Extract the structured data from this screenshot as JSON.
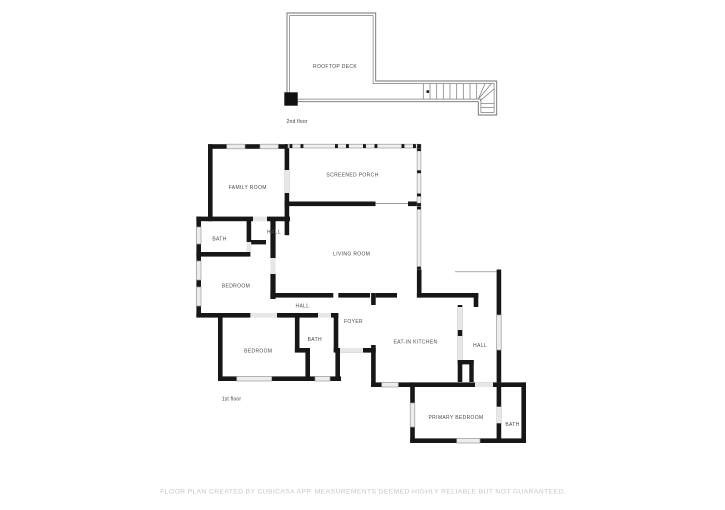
{
  "floors": [
    {
      "id": "second-floor",
      "label": "2nd floor",
      "rooms": [
        {
          "id": "rooftop-deck",
          "label": "ROOFTOP DECK"
        }
      ]
    },
    {
      "id": "first-floor",
      "label": "1st floor",
      "rooms": [
        {
          "id": "family-room",
          "label": "FAMILY ROOM"
        },
        {
          "id": "screened-porch",
          "label": "SCREENED PORCH"
        },
        {
          "id": "bath-upper",
          "label": "BATH"
        },
        {
          "id": "hall-upper",
          "label": "HALL"
        },
        {
          "id": "living-room",
          "label": "LIVING ROOM"
        },
        {
          "id": "bedroom-upper",
          "label": "BEDROOM"
        },
        {
          "id": "hall-center",
          "label": "HALL"
        },
        {
          "id": "foyer",
          "label": "FOYER"
        },
        {
          "id": "bath-center",
          "label": "BATH"
        },
        {
          "id": "bedroom-lower",
          "label": "BEDROOM"
        },
        {
          "id": "eat-in-kitchen",
          "label": "EAT-IN KITCHEN"
        },
        {
          "id": "hall-right",
          "label": "HALL"
        },
        {
          "id": "primary-bedroom",
          "label": "PRIMARY BEDROOM"
        },
        {
          "id": "bath-primary",
          "label": "BATH"
        }
      ]
    }
  ],
  "footer": {
    "disclaimer": "FLOOR PLAN CREATED BY CUBICASA APP. MEASUREMENTS DEEMED HIGHLY RELIABLE BUT NOT GUARANTEED."
  },
  "colors": {
    "background": "#ffffff",
    "wall": "#171717",
    "window_fill": "#ededed",
    "opening_fill": "#e7e7e7",
    "thin_wall": "#6f6f6f",
    "room_label": "#4a4a4a",
    "footer_text": "#c8c8c8"
  }
}
